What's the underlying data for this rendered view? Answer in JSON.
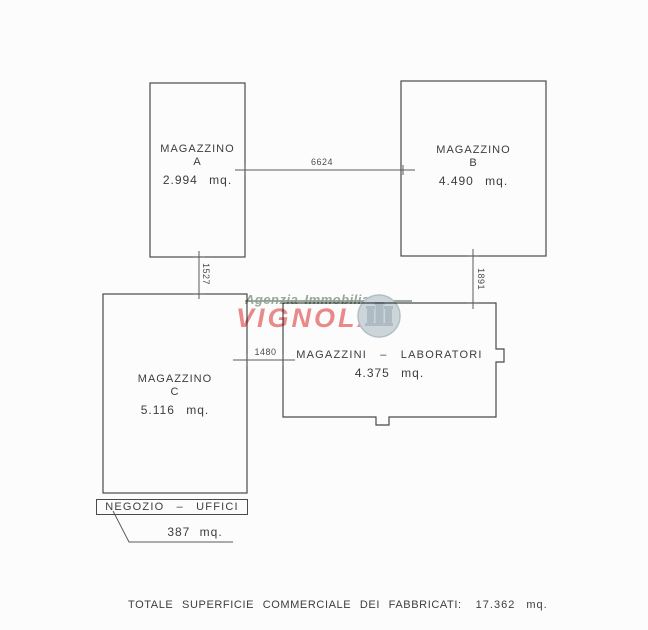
{
  "plan": {
    "buildings": [
      {
        "name": "MAGAZZINO",
        "letter": "A",
        "area": "2.994 mq."
      },
      {
        "name": "MAGAZZINO",
        "letter": "B",
        "area": "4.490 mq."
      },
      {
        "name": "MAGAZZINO",
        "letter": "C",
        "area": "5.116 mq."
      },
      {
        "name": "MAGAZZINI – LABORATORI",
        "area": "4.375 mq."
      }
    ],
    "shop": {
      "label": "NEGOZIO – UFFICI",
      "area": "387 mq."
    },
    "dimensions": {
      "a_b": "6624",
      "a_c": "1527",
      "b_lab": "1891",
      "c_lab": "1480"
    },
    "total_label": "TOTALE SUPERFICIE COMMERCIALE DEI FABBRICATI:",
    "total_value": "17.362 mq."
  },
  "watermark": {
    "agency_line1": "Agenzia Immobiliare",
    "agency_line2": "VIGNOLA",
    "colors": {
      "line1": "#8fa092",
      "line2": "#ec8c8c",
      "logo": "#cfd8dd"
    }
  },
  "colors": {
    "line": "#4a4a4a",
    "text": "#3d3d3d",
    "background": "#fcfcfc"
  }
}
